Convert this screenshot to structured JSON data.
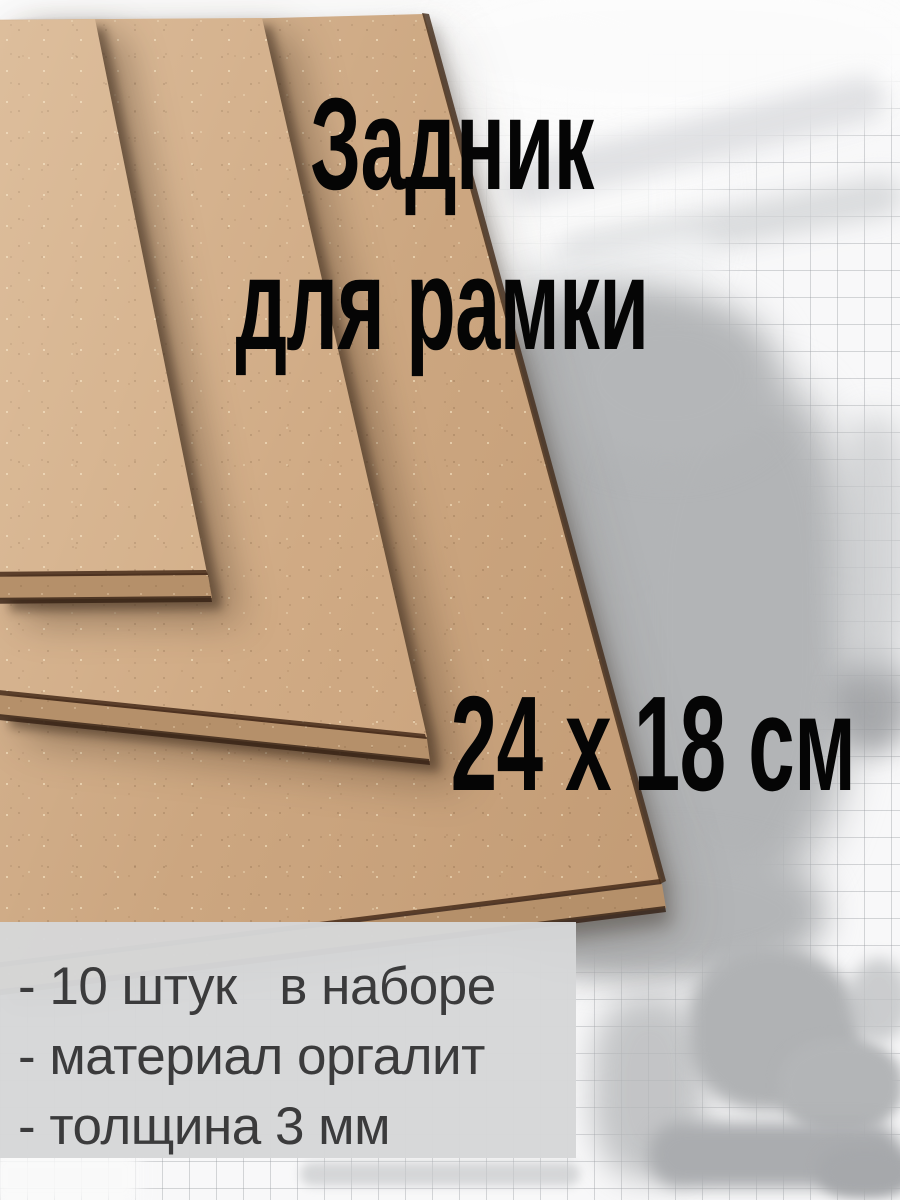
{
  "title": {
    "line1": "Задник",
    "line2": "для рамки"
  },
  "size_label": "24 x 18 см",
  "specs": [
    "- 10 штук   в наборе",
    "- материал оргалит",
    "- толщина 3 мм"
  ],
  "colors": {
    "board_tan": "#cba37c",
    "board_side": "#b5906a",
    "board_edge_dark": "#4a2f1c",
    "background_paper": "#f8f8f9",
    "grid_line": "#c7c9cb",
    "wash_gray": "#b2b4b6",
    "panel_bg": "#d6d7d8",
    "title_color": "#050505",
    "spec_text_color": "#3b3b3c"
  }
}
